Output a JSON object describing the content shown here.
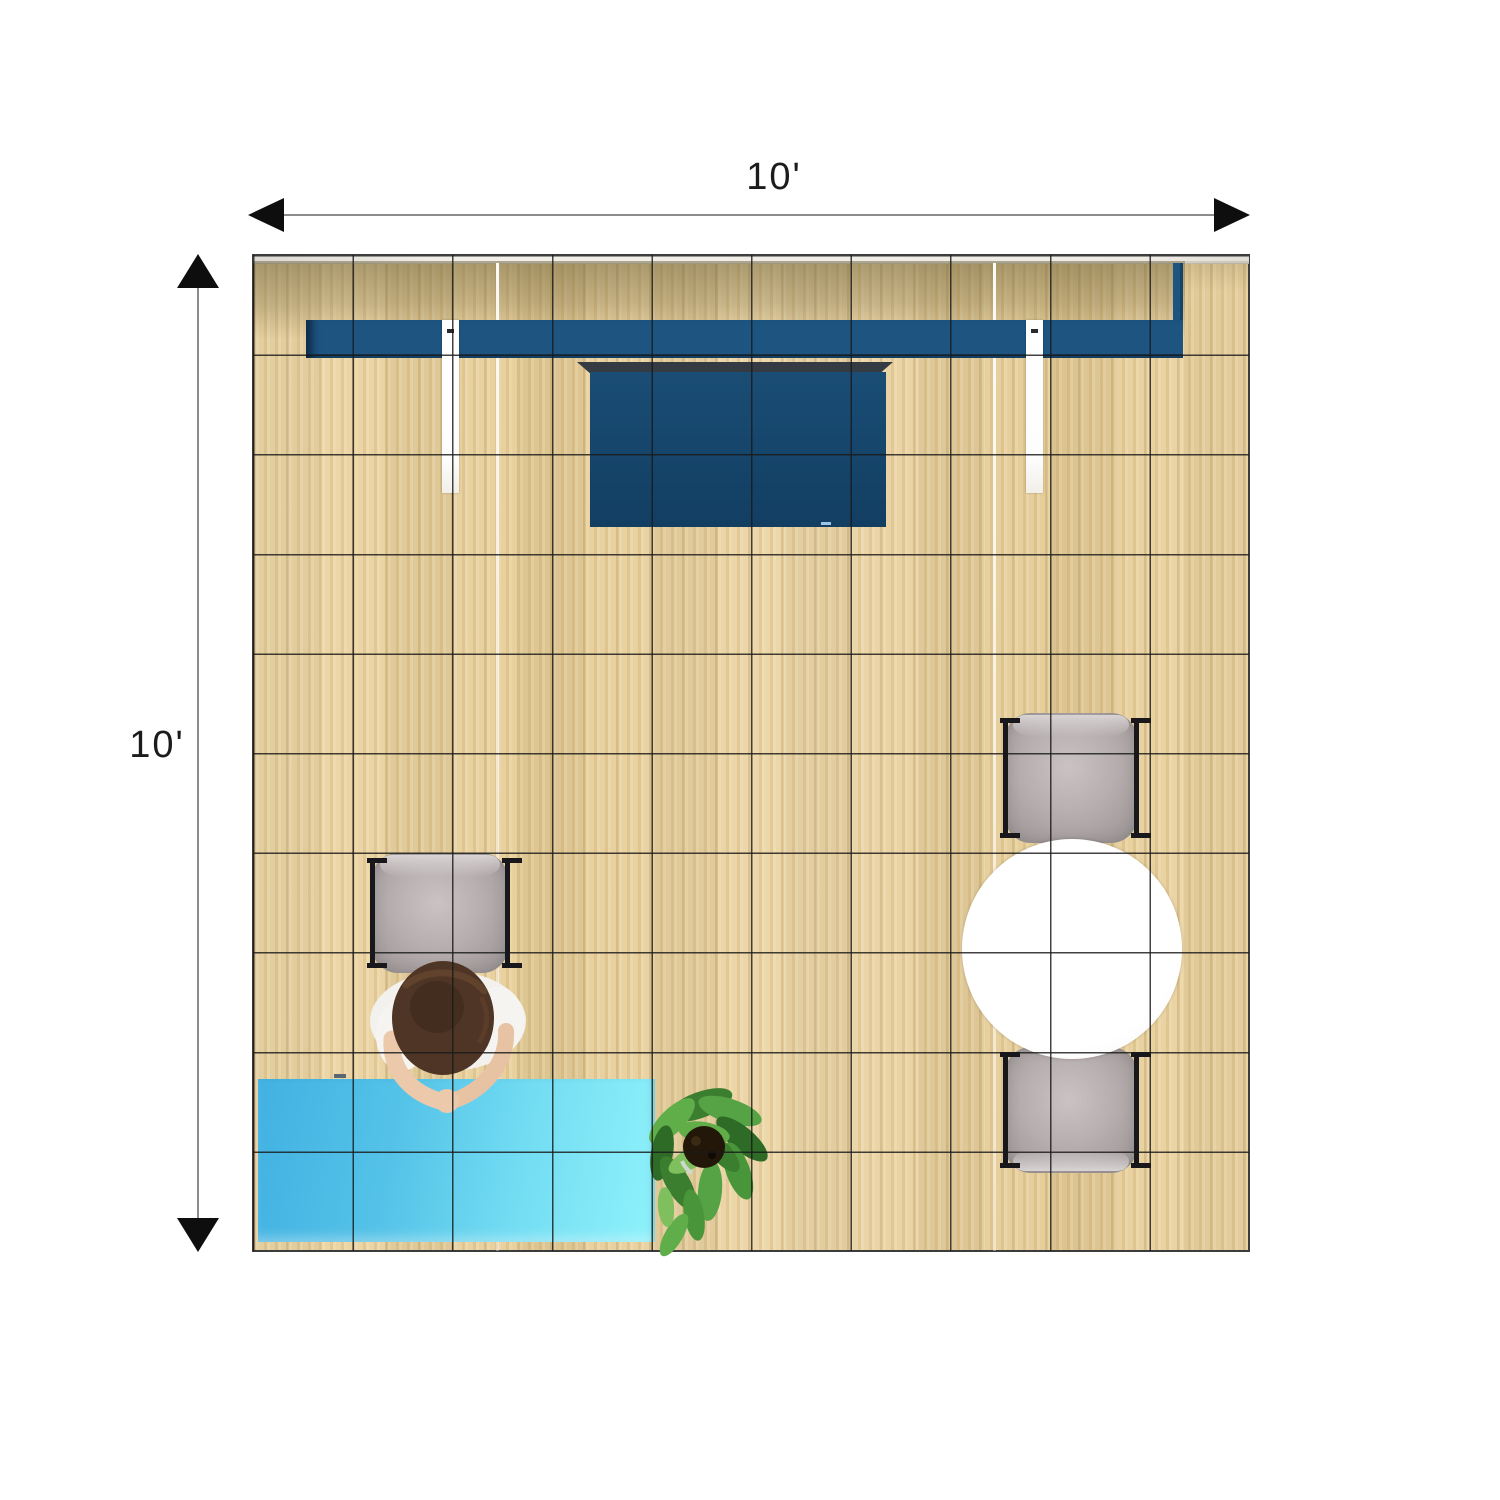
{
  "title": "10 x 10 booth floor plan (top view)",
  "dimensions": {
    "width_label": "10'",
    "height_label": "10'"
  },
  "floor": {
    "grid_cols": 10,
    "grid_rows": 10,
    "wood_color": "#e9d2a0",
    "grid_line_color": "#191919",
    "border_color": "#3c3c3c"
  },
  "objects": {
    "header_wall": {
      "label": "back wall header shelf",
      "color": "#1d5480"
    },
    "tv": {
      "label": "wall-mounted display",
      "color": "#174a70",
      "mount_color": "#343b43"
    },
    "light_strips": {
      "count": 2,
      "color": "#ffffff"
    },
    "reception_desk": {
      "label": "reception counter",
      "color_start": "#41b1e2",
      "color_end": "#8ff2fb"
    },
    "chairs": {
      "count": 3,
      "cushion_color": "#b7afaf",
      "frame_color": "#17171c"
    },
    "round_table": {
      "color": "#ffffff"
    },
    "plant": {
      "leaf_color": "#49953a",
      "soil_color": "#221708"
    },
    "person": {
      "hair_color": "#4e3525",
      "shirt_color": "#f3f1ee",
      "skin_color": "#ecc9ab"
    }
  }
}
